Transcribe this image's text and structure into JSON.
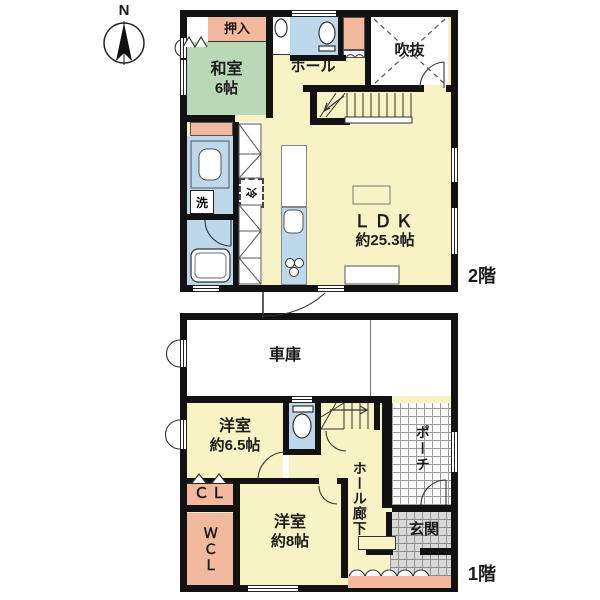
{
  "compass": {
    "north": "N"
  },
  "floor2": {
    "label": "2階",
    "oshiire": "押入",
    "washitsu_name": "和室",
    "washitsu_size": "6帖",
    "hall": "ホール",
    "void": "吹抜",
    "ldk_name": "ＬＤＫ",
    "ldk_size": "約25.3帖",
    "fridge": "冷",
    "washer": "洗"
  },
  "floor1": {
    "label": "1階",
    "garage": "車庫",
    "room65_name": "洋室",
    "room65_size": "約6.5帖",
    "closet": "ＣＬ",
    "walkin_closet": "ＷＣＬ",
    "room8_name": "洋室",
    "room8_size": "約8帖",
    "hall_corridor": "ホール廊下",
    "porch": "ポーチ",
    "entrance": "玄関"
  },
  "colors": {
    "room_yellow": "#f7f3c4",
    "tatami_green": "#b9d8b6",
    "closet_salmon": "#f3b99e",
    "wet_blue": "#bdd8eb",
    "tile_gray": "#d8d8d8",
    "wall_black": "#121212"
  }
}
